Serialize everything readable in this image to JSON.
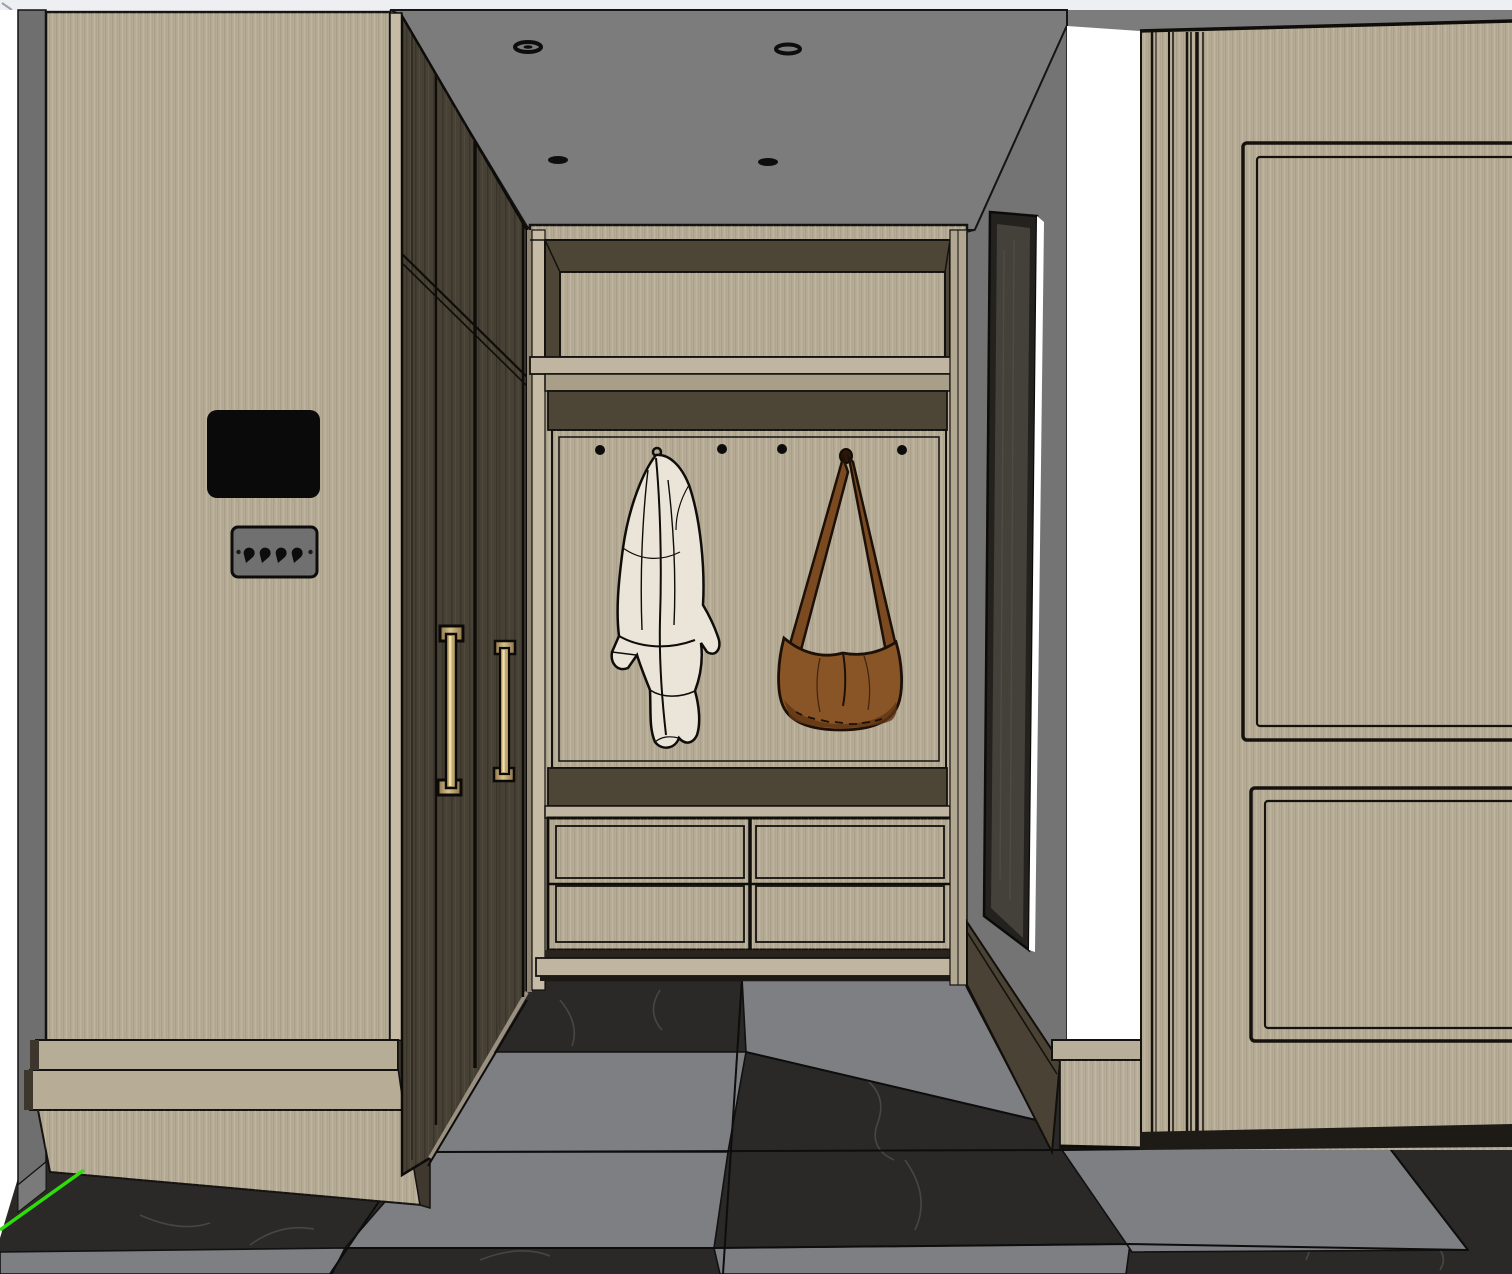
{
  "app": {
    "name": "3d-interior-viewport",
    "description": "SketchUp-style rendered hallway / mudroom interior scene"
  },
  "scene": {
    "objects": {
      "ceiling_lights": {
        "label": "recessed-downlight",
        "count": 4
      },
      "wall_tablet": {
        "label": "wall-mounted-tablet"
      },
      "light_switch": {
        "label": "4-gang-toggle-switch",
        "toggles": 4
      },
      "wardrobe": {
        "label": "dark-wardrobe",
        "doors": 3,
        "handles": 2
      },
      "mudroom_unit": {
        "label": "built-in-mudroom-unit",
        "drawers": 4,
        "hooks_visible": 4,
        "hooks_total": 6
      },
      "jacket": {
        "label": "hanging-jacket"
      },
      "bag": {
        "label": "hanging-leather-bag"
      },
      "mirror": {
        "label": "framed-mirror"
      },
      "doorway": {
        "label": "bright-doorway-opening"
      },
      "entry_door": {
        "label": "paneled-entry-door",
        "panels": 2
      },
      "floor": {
        "label": "checkerboard-marble-floor",
        "tile_colors": [
          "dark-marble",
          "gray"
        ]
      },
      "axis_line": {
        "label": "sketchup-green-axis"
      }
    },
    "colors": {
      "top_strip": "#edeff3",
      "ceiling_gray": "#7c7c7c",
      "wall_gray": "#747474",
      "edge_gray": "#6f6f6f",
      "white": "#ffffff",
      "wood_light": "#b7ac96",
      "wood_corner": "#c6bca6",
      "wood_mid": "#a99e88",
      "wood_dark": "#474034",
      "bevel_dark": "#4d4536",
      "outline": "#141210",
      "floor_marble": "#2a2927",
      "floor_gray": "#7e7f82",
      "vein": "#6b6a62",
      "brass": "#c0a76e",
      "brass_dark": "#8a7248",
      "bag_brown": "#8a5526",
      "bag_dark": "#5f3614",
      "jacket_cream": "#eae5d8",
      "mirror_dark": "#434139",
      "skirting_dark": "#4a4234",
      "switch_gray": "#707070",
      "tablet_black": "#0a0a0a",
      "axis_green": "#2fdd08"
    }
  }
}
